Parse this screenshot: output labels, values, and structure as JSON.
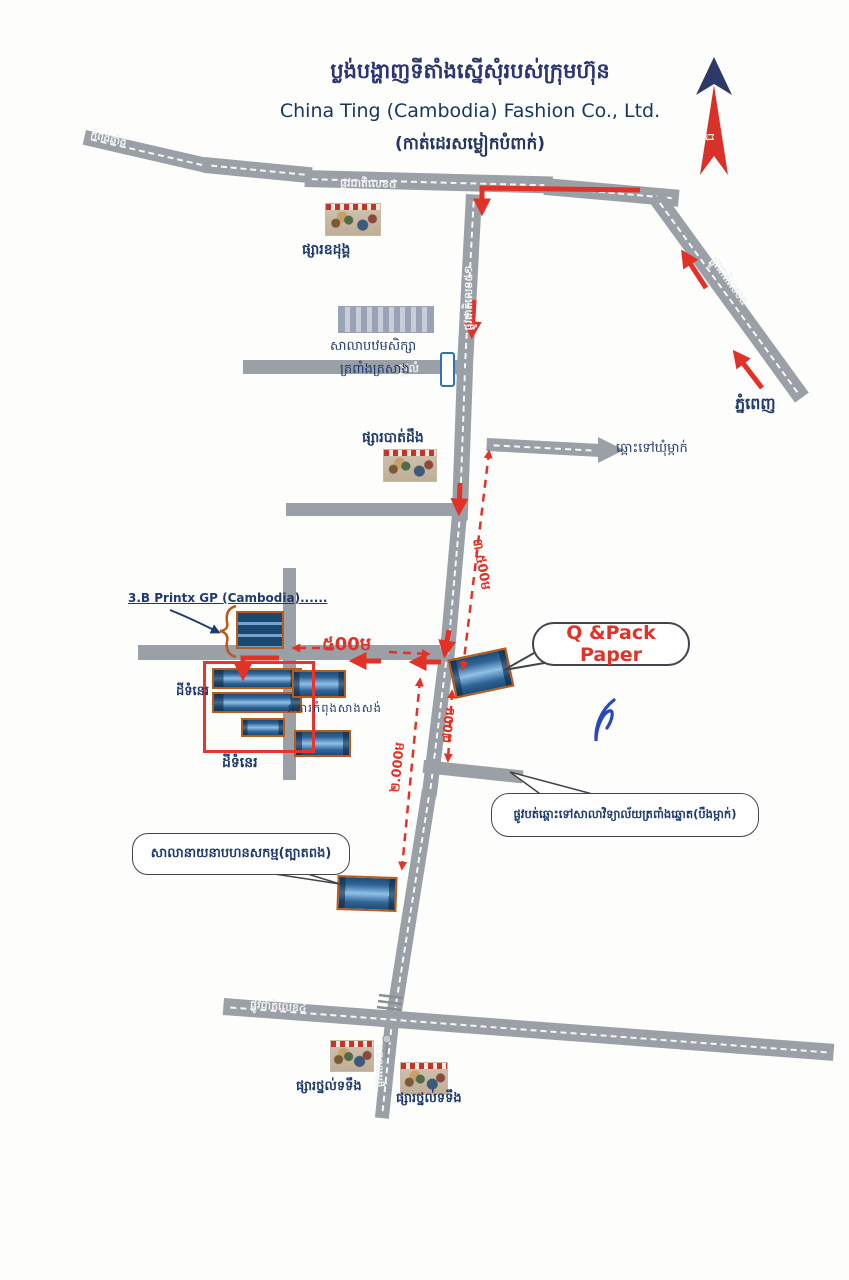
{
  "header": {
    "title_khmer": "ប្លង់បង្ហាញទីតាំងស្នើសុំរបស់ក្រុមហ៊ុន",
    "company": "China Ting (Cambodia) Fashion Co., Ltd.",
    "subtitle_khmer": "(កាត់ដេរសម្លៀកបំពាក់)"
  },
  "compass": {
    "north_letter": "ជ"
  },
  "road_labels": {
    "nr5_top": "ផ្លូវជាតិលេខ៥",
    "nr5_diagonal": "ផ្លូវជាតិលេខ៥",
    "nr51_upper": "ផ្លូវជាតិលេខ៥១",
    "nr51_lower": "ផ្លូវលេខ៥១",
    "nr4": "ផ្លូវជាតិលេខ៤",
    "dirt_road": "ផ្លូវលំ",
    "dest_northwest": "កំពង់ឆ្នាំង",
    "dest_phnom_penh": "ភ្នំពេញ",
    "dest_khum_mkak": "ឆ្ពោះទៅឃុំម្កាក់"
  },
  "distances": {
    "d500": "៥00ម",
    "d3500": "៣.៥00ម",
    "d2000": "២.000ម",
    "d700": "៧00ម"
  },
  "landmarks": {
    "oudong_market": "ផ្សារឧដុង្គ",
    "school_line1": "សាលាបឋមសិក្សា",
    "school_line2": "ត្រពាំងត្រសាង",
    "batdoeng_market": "ផ្សារបាត់ដឹង",
    "printx_label": "3.B Printx GP (Cambodia)......",
    "qpack_label": "Q &Pack Paper",
    "vacant_land_1": "ដីទំនេរ",
    "vacant_land_2": "ដីទំនេរ",
    "under_construction": "អគារកំពុងសាងសង់",
    "branch_note": "ផ្លូវបត់ឆ្ពោះទៅសាលាវិទ្យាល័យត្រពាំងឆ្នោត(បឹងម្កាក់)",
    "commune_hall_note": "សាលានាយនាបហនសកម្ម(ត្បាតពង)",
    "thnal_totung_left": "ផ្សារថ្នល់ទទឹង",
    "thnal_totung_right": "ផ្សារថ្នល់ទទឹង"
  },
  "colors": {
    "road_gray": "#9aa0a6",
    "route_red": "#e23227",
    "building_blue": "#2f6496",
    "building_outline": "#b85c1c",
    "label_navy": "#1f3a6e",
    "ink_blue": "#2947b8",
    "compass_red": "#d9302a",
    "compass_navy": "#2d3a67"
  }
}
